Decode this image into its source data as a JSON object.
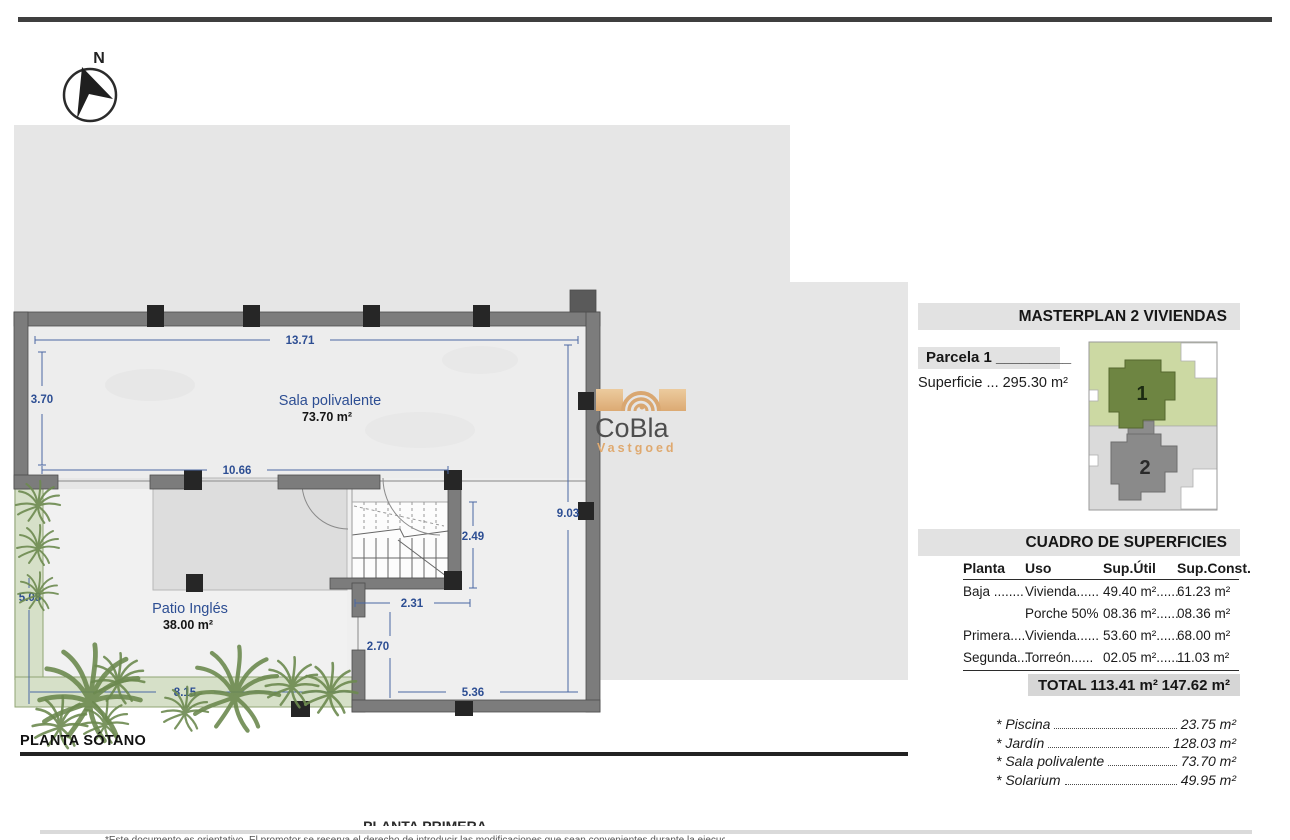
{
  "compass": {
    "label": "N"
  },
  "logo": {
    "brand": "CoBla",
    "sub": "Vastgoed"
  },
  "plan": {
    "title": "PLANTA SÓTANO",
    "room1_name": "Sala polivalente",
    "room1_area": "73.70 m²",
    "room2_name": "Patio Inglés",
    "room2_area": "38.00 m²",
    "dims": {
      "top": "13.71",
      "left": "3.70",
      "inner": "10.66",
      "right": "9.03",
      "stair": "2.49",
      "core": "2.31",
      "lower": "2.70",
      "room": "5.36",
      "garden_left": "5.08",
      "garden_bottom": "8.15"
    }
  },
  "masterplan": {
    "title": "MASTERPLAN 2 VIVIENDAS",
    "parcel": "Parcela 1 _________",
    "surface": "Superficie ... 295.30 m²",
    "unit1": "1",
    "unit2": "2"
  },
  "surfaces": {
    "title": "CUADRO DE SUPERFICIES",
    "col_planta": "Planta",
    "col_uso": "Uso",
    "col_util": "Sup.Útil",
    "col_const": "Sup.Const.",
    "rows": [
      {
        "planta": "Baja ........",
        "uso": "Vivienda......",
        "util": "49.40 m²......",
        "constr": "61.23 m²"
      },
      {
        "planta": "",
        "uso": "Porche 50%",
        "util": "08.36 m²......",
        "constr": "08.36 m²"
      },
      {
        "planta": "Primera....",
        "uso": "Vivienda......",
        "util": "53.60 m²......",
        "constr": "68.00 m²"
      },
      {
        "planta": "Segunda...",
        "uso": "Torreón......",
        "util": "02.05 m²......",
        "constr": "11.03 m²"
      }
    ],
    "total_label": "TOTAL",
    "total_util": "113.41 m²",
    "total_const": "147.62 m²"
  },
  "extras": [
    {
      "name": "* Piscina",
      "value": "23.75 m²"
    },
    {
      "name": "* Jardín",
      "value": "128.03 m²"
    },
    {
      "name": "* Sala polivalente",
      "value": "73.70 m²"
    },
    {
      "name": "* Solarium",
      "value": "49.95 m²"
    }
  ],
  "clipped": {
    "next_heading": "PLANTA PRIMERA",
    "disclaimer": "*Este documento es orientativo. El promotor se reserva el derecho de introducir las modificaciones que sean convenientes durante la ejecución de la obra."
  }
}
